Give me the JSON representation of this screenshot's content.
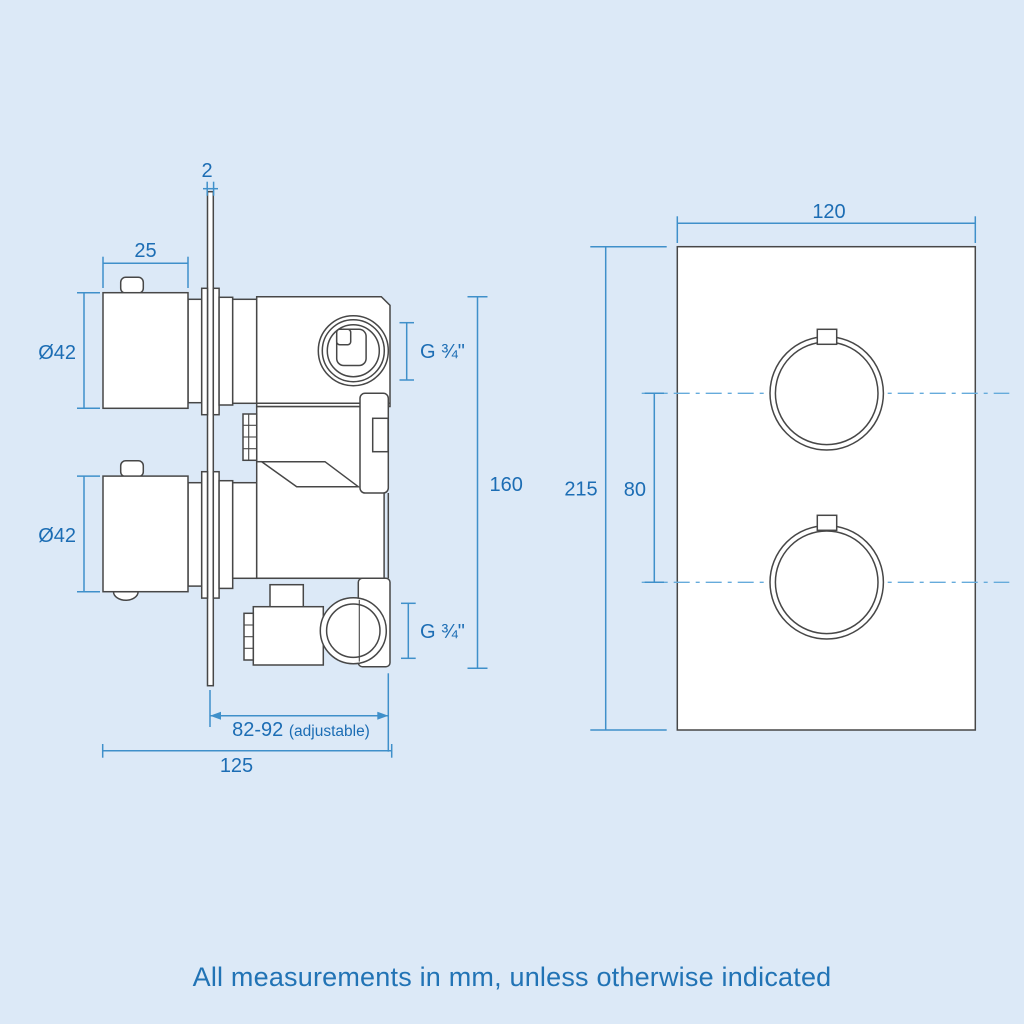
{
  "colors": {
    "background": "#dce9f7",
    "drawing_line": "#474747",
    "dimension_line": "#3f90ca",
    "dimension_text": "#1c6db4",
    "caption_text": "#2173b5",
    "centerline": "#66abdb"
  },
  "caption": "All measurements in mm, unless otherwise indicated",
  "side_view": {
    "description": "side profile of concealed twin thermostatic shower valve",
    "dims": {
      "plate_thickness": "2",
      "knob_depth": "25",
      "top_knob_diameter": "Ø42",
      "bottom_knob_diameter": "Ø42",
      "top_outlet_thread": "G ¾\"",
      "bottom_outlet_thread": "G ¾\"",
      "body_height": "160",
      "recess_depth": "82-92 ",
      "recess_depth_note": "(adjustable)",
      "total_depth": "125"
    }
  },
  "front_view": {
    "description": "front face plate with two round control dials",
    "dims": {
      "plate_width": "120",
      "plate_height": "215",
      "dial_spacing": "80"
    }
  }
}
